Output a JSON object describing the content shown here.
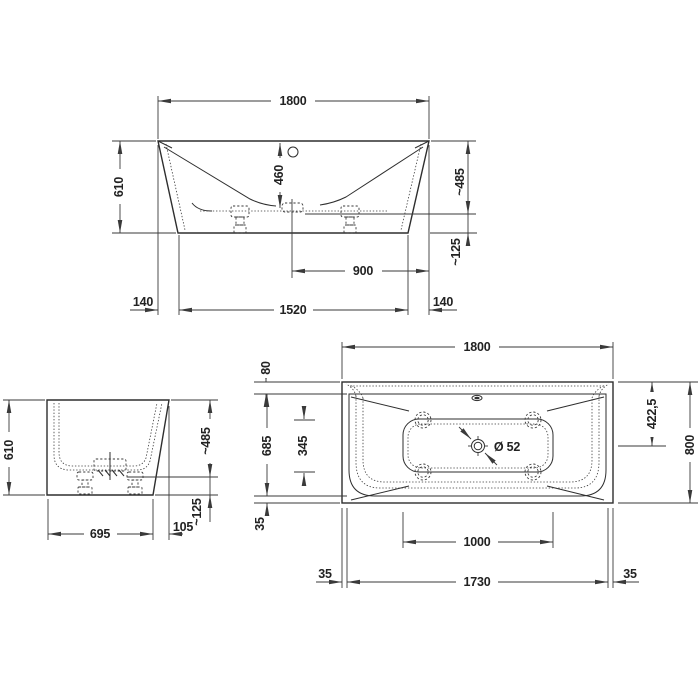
{
  "drawing_colors": {
    "line": "#2e2e2e",
    "dimension_line": "#3a3a3a",
    "background": "#ffffff"
  },
  "front": {
    "overall_width": "1800",
    "overall_height": "610",
    "inner_depth": "460",
    "rim_to_ledge": "~485",
    "base_height": "~125",
    "center_to_right": "900",
    "left_inset": "140",
    "base_width": "1520",
    "right_inset": "140"
  },
  "side": {
    "overall_height": "610",
    "rim_to_ledge": "~485",
    "base_height": "~125",
    "base_width": "695",
    "rim_overhang": "105"
  },
  "plan": {
    "overall_length": "1800",
    "rim_top": "80",
    "inner_width": "685",
    "floor_width": "345",
    "rim_bottom": "35",
    "drain_from_edge": "422,5",
    "overall_width": "800",
    "floor_length": "1000",
    "rim_left": "35",
    "inner_length": "1730",
    "rim_right": "35",
    "drain_diameter": "Ø 52"
  }
}
